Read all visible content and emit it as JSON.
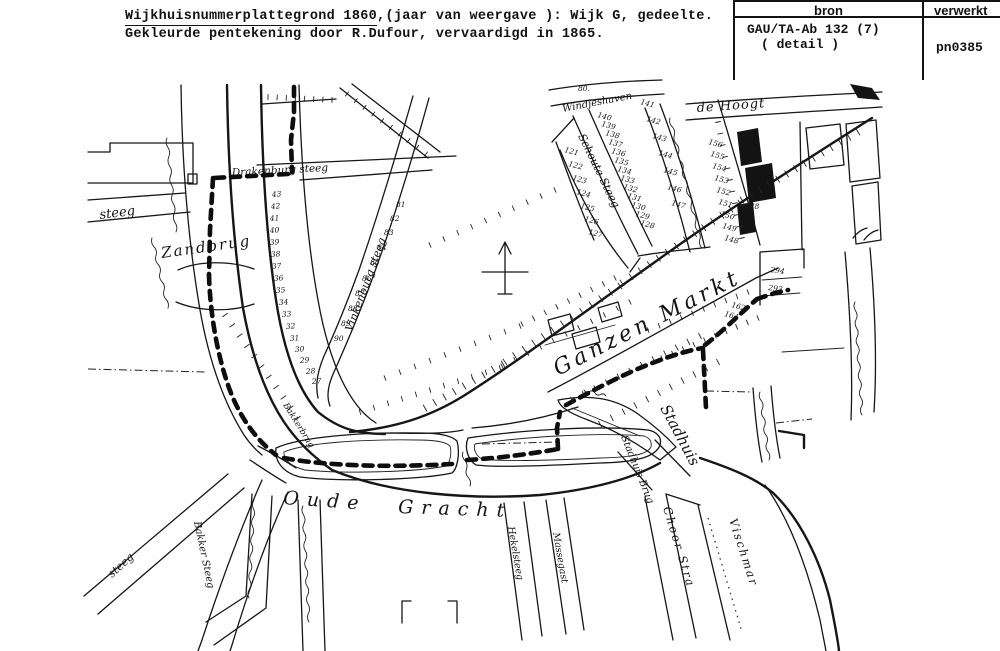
{
  "header": {
    "title_underlined": "Wijkhuisnummerplattegrond 1860",
    "title_rest": ",(jaar van weergave ): Wijk G, gedeelte.",
    "title_line2": "Gekleurde pentekening door R.Dufour, vervaardigd in 1865."
  },
  "table": {
    "col1_header": "bron",
    "col2_header": "verwerkt",
    "col1_value_line1": "GAU/TA-Ab 132 (7)",
    "col1_value_line2": "( detail )",
    "col2_value": "pn0385"
  },
  "map": {
    "labels": [
      {
        "t": "steeg",
        "x": 100,
        "y": 219,
        "r": -7,
        "s": 13
      },
      {
        "t": "Zandbrug",
        "x": 162,
        "y": 258,
        "r": -8,
        "s": 15,
        "ls": 2
      },
      {
        "t": "Drakenburg steeg",
        "x": 232,
        "y": 176,
        "r": -3,
        "s": 10.5
      },
      {
        "t": "Vinkenburg steeg",
        "x": 352,
        "y": 332,
        "r": -70,
        "s": 11
      },
      {
        "t": "Windjeshaven",
        "x": 563,
        "y": 112,
        "r": -11,
        "s": 10
      },
      {
        "t": "de Hoogt",
        "x": 697,
        "y": 112,
        "r": -4,
        "s": 13,
        "ls": 1
      },
      {
        "t": "Schoute Steeg",
        "x": 578,
        "y": 136,
        "r": 64,
        "s": 11
      },
      {
        "t": "Ganzen Markt",
        "x": 558,
        "y": 376,
        "r": -27,
        "s": 22,
        "ls": 4
      },
      {
        "t": "Stadhuis",
        "x": 660,
        "y": 408,
        "r": 62,
        "s": 15
      },
      {
        "t": "Stadhuis Brug",
        "x": 621,
        "y": 437,
        "r": 68,
        "s": 10
      },
      {
        "t": "Choor Stra",
        "x": 663,
        "y": 508,
        "r": 73,
        "s": 11.5,
        "ls": 2
      },
      {
        "t": "Vischmar",
        "x": 729,
        "y": 520,
        "r": 72,
        "s": 11.5,
        "ls": 2
      },
      {
        "t": "Oude",
        "x": 283,
        "y": 504,
        "r": 4,
        "s": 19,
        "ls": 8
      },
      {
        "t": "Gracht",
        "x": 398,
        "y": 513,
        "r": 2,
        "s": 19,
        "ls": 8
      },
      {
        "t": "Bakker Steeg",
        "x": 194,
        "y": 522,
        "r": 78,
        "s": 10
      },
      {
        "t": "steeg",
        "x": 112,
        "y": 578,
        "r": -42,
        "s": 11
      },
      {
        "t": "Hekelsteeg",
        "x": 508,
        "y": 527,
        "r": 80,
        "s": 9.5
      },
      {
        "t": "Massegast",
        "x": 553,
        "y": 533,
        "r": 80,
        "s": 9.5
      },
      {
        "t": "Bakkerbrug",
        "x": 283,
        "y": 405,
        "r": 58,
        "s": 8.5
      }
    ],
    "numbers": [
      {
        "t": "43",
        "x": 272,
        "y": 197,
        "r": -4
      },
      {
        "t": "42",
        "x": 271,
        "y": 209,
        "r": -4
      },
      {
        "t": "41",
        "x": 270,
        "y": 221,
        "r": -4
      },
      {
        "t": "40",
        "x": 270,
        "y": 233,
        "r": -4
      },
      {
        "t": "39",
        "x": 270,
        "y": 245,
        "r": -4
      },
      {
        "t": "38",
        "x": 271,
        "y": 257,
        "r": -4
      },
      {
        "t": "37",
        "x": 272,
        "y": 269,
        "r": -4
      },
      {
        "t": "36",
        "x": 274,
        "y": 281,
        "r": -4
      },
      {
        "t": "35",
        "x": 276,
        "y": 293,
        "r": -4
      },
      {
        "t": "34",
        "x": 279,
        "y": 305,
        "r": -4
      },
      {
        "t": "33",
        "x": 282,
        "y": 317,
        "r": -4
      },
      {
        "t": "32",
        "x": 286,
        "y": 329,
        "r": -4
      },
      {
        "t": "31",
        "x": 290,
        "y": 341,
        "r": -4
      },
      {
        "t": "30",
        "x": 295,
        "y": 352,
        "r": -4
      },
      {
        "t": "29",
        "x": 300,
        "y": 363,
        "r": -4
      },
      {
        "t": "28",
        "x": 306,
        "y": 374,
        "r": -4
      },
      {
        "t": "27",
        "x": 312,
        "y": 384,
        "r": -4
      },
      {
        "t": "81",
        "x": 396,
        "y": 207,
        "r": 0
      },
      {
        "t": "82",
        "x": 390,
        "y": 221,
        "r": 0
      },
      {
        "t": "83",
        "x": 384,
        "y": 235,
        "r": 0
      },
      {
        "t": "84",
        "x": 377,
        "y": 250,
        "r": 0
      },
      {
        "t": "85",
        "x": 370,
        "y": 265,
        "r": 0
      },
      {
        "t": "86",
        "x": 362,
        "y": 281,
        "r": 0
      },
      {
        "t": "87",
        "x": 355,
        "y": 296,
        "r": 0
      },
      {
        "t": "88",
        "x": 348,
        "y": 311,
        "r": 0
      },
      {
        "t": "89",
        "x": 341,
        "y": 326,
        "r": 0
      },
      {
        "t": "90",
        "x": 334,
        "y": 341,
        "r": 0
      },
      {
        "t": "141",
        "x": 640,
        "y": 104,
        "r": 15
      },
      {
        "t": "142",
        "x": 646,
        "y": 121,
        "r": 15
      },
      {
        "t": "143",
        "x": 652,
        "y": 138,
        "r": 15
      },
      {
        "t": "144",
        "x": 658,
        "y": 155,
        "r": 15
      },
      {
        "t": "145",
        "x": 663,
        "y": 172,
        "r": 15
      },
      {
        "t": "146",
        "x": 667,
        "y": 189,
        "r": 15
      },
      {
        "t": "147",
        "x": 671,
        "y": 205,
        "r": 15
      },
      {
        "t": "140",
        "x": 597,
        "y": 117,
        "r": 15
      },
      {
        "t": "139",
        "x": 601,
        "y": 126,
        "r": 15
      },
      {
        "t": "138",
        "x": 605,
        "y": 135,
        "r": 15
      },
      {
        "t": "137",
        "x": 608,
        "y": 144,
        "r": 15
      },
      {
        "t": "136",
        "x": 611,
        "y": 153,
        "r": 15
      },
      {
        "t": "135",
        "x": 614,
        "y": 162,
        "r": 15
      },
      {
        "t": "134",
        "x": 617,
        "y": 171,
        "r": 15
      },
      {
        "t": "133",
        "x": 620,
        "y": 180,
        "r": 15
      },
      {
        "t": "132",
        "x": 623,
        "y": 189,
        "r": 15
      },
      {
        "t": "131",
        "x": 627,
        "y": 198,
        "r": 15
      },
      {
        "t": "130",
        "x": 631,
        "y": 207,
        "r": 15
      },
      {
        "t": "129",
        "x": 635,
        "y": 216,
        "r": 15
      },
      {
        "t": "128",
        "x": 640,
        "y": 225,
        "r": 15
      },
      {
        "t": "121",
        "x": 564,
        "y": 152,
        "r": 15
      },
      {
        "t": "122",
        "x": 568,
        "y": 166,
        "r": 15
      },
      {
        "t": "123",
        "x": 572,
        "y": 180,
        "r": 15
      },
      {
        "t": "124",
        "x": 576,
        "y": 194,
        "r": 15
      },
      {
        "t": "125",
        "x": 580,
        "y": 208,
        "r": 15
      },
      {
        "t": "126",
        "x": 584,
        "y": 221,
        "r": 15
      },
      {
        "t": "127",
        "x": 588,
        "y": 234,
        "r": 15
      },
      {
        "t": "156",
        "x": 708,
        "y": 144,
        "r": 15
      },
      {
        "t": "155",
        "x": 710,
        "y": 156,
        "r": 15
      },
      {
        "t": "154",
        "x": 712,
        "y": 168,
        "r": 15
      },
      {
        "t": "153",
        "x": 714,
        "y": 180,
        "r": 15
      },
      {
        "t": "152",
        "x": 716,
        "y": 192,
        "r": 15
      },
      {
        "t": "151",
        "x": 718,
        "y": 204,
        "r": 15
      },
      {
        "t": "150",
        "x": 720,
        "y": 216,
        "r": 15
      },
      {
        "t": "149",
        "x": 722,
        "y": 228,
        "r": 15
      },
      {
        "t": "148",
        "x": 724,
        "y": 240,
        "r": 15
      },
      {
        "t": "80.",
        "x": 578,
        "y": 91,
        "r": 0
      },
      {
        "t": "278",
        "x": 745,
        "y": 209,
        "r": 0
      },
      {
        "t": "294",
        "x": 770,
        "y": 272,
        "r": 8
      },
      {
        "t": "293",
        "x": 768,
        "y": 290,
        "r": 8
      },
      {
        "t": "162",
        "x": 731,
        "y": 307,
        "r": 15
      },
      {
        "t": "164",
        "x": 724,
        "y": 316,
        "r": 15
      }
    ]
  }
}
